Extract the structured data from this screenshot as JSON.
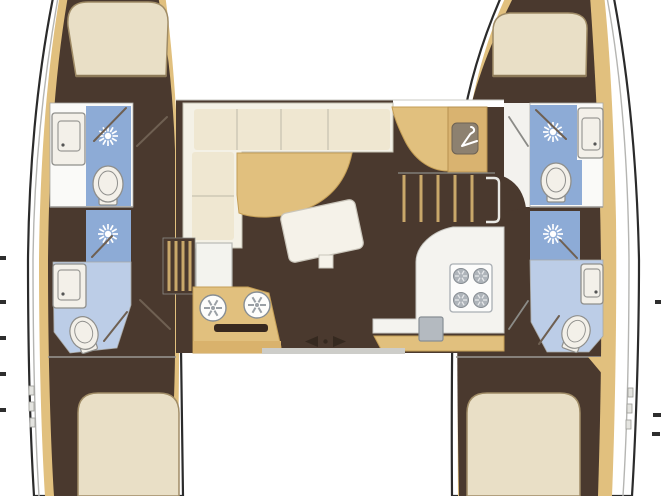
{
  "meta": {
    "description": "Catamaran sailing yacht interior floor plan, top-down view",
    "view": "top-down",
    "canvas": {
      "width": 661,
      "height": 496
    }
  },
  "colors": {
    "background": "#ffffff",
    "hull_outline": "#2b2b2b",
    "deck_line": "#b5b5b2",
    "interior_floor": "#4a392e",
    "wood_trim": "#e1c07e",
    "wood_dark": "#d9b26c",
    "stair_tread": "#c9a86a",
    "bed": "#e9dfc6",
    "bed_edge": "#a08c66",
    "sofa": "#f4f1e6",
    "cushion": "#efe7d1",
    "cushion_seam": "#c6c2b0",
    "bath_room_white": "#fafaf8",
    "bath_floor_light": "#bccde7",
    "shower_tile": "#8dabd6",
    "fixture_white": "#f3f0e9",
    "fixture_line": "#8f8f8c",
    "appliance_gray": "#b4bac0",
    "appliance_line": "#878e94",
    "wardrobe_panel": "#8d8170",
    "divider": "#9a9894",
    "icon_dark": "#35291f"
  },
  "icons": [
    {
      "name": "shower-head-icon",
      "count": 4
    },
    {
      "name": "toilet-icon",
      "count": 4
    },
    {
      "name": "bathroom-sink-icon",
      "count": 4
    },
    {
      "name": "galley-sink-icon",
      "count": 2
    },
    {
      "name": "stove-burner-icon",
      "count": 4
    },
    {
      "name": "wardrobe-hanger-icon",
      "count": 1
    },
    {
      "name": "sliding-door-arrows-icon",
      "count": 1
    }
  ],
  "layout": {
    "port_hull": {
      "rooms": [
        "forward-cabin-double-berth",
        "forward-head-shower-toilet-sink",
        "aft-head-shower-toilet-sink",
        "aft-cabin-double-berth"
      ]
    },
    "starboard_hull": {
      "rooms": [
        "forward-cabin-double-berth",
        "forward-head-shower-toilet-sink",
        "aft-head-shower-toilet-sink",
        "aft-cabin-double-berth"
      ]
    },
    "saloon": {
      "features": [
        "l-shaped-sofa",
        "dining-table",
        "coffee-table",
        "nav-station-with-wardrobe",
        "starboard-companionway-stairs",
        "port-companionway-stairs",
        "galley-sink-counter",
        "galley-stove-counter",
        "cockpit-sliding-door"
      ]
    }
  }
}
